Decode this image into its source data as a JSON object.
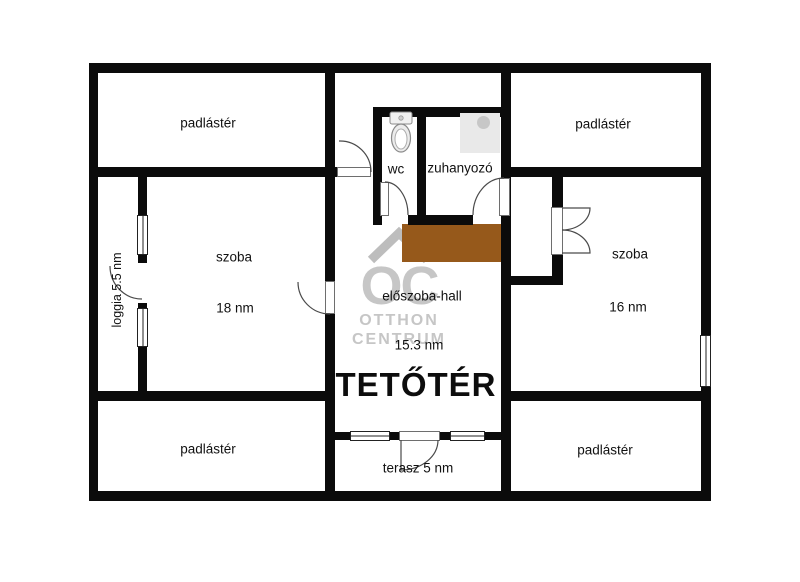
{
  "floor_title": "TETŐTÉR",
  "rooms": {
    "attic_top_left": {
      "label": "padlástér"
    },
    "attic_top_right": {
      "label": "padlástér"
    },
    "attic_bottom_left": {
      "label": "padlástér"
    },
    "attic_bottom_right": {
      "label": "padlástér"
    },
    "room_left": {
      "label": "szoba",
      "area": "18 nm"
    },
    "room_right": {
      "label": "szoba",
      "area": "16 nm"
    },
    "wc": {
      "label": "wc"
    },
    "shower": {
      "label": "zuhanyozó"
    },
    "hall": {
      "label": "előszoba-hall",
      "area": "15.3 nm"
    },
    "terrace": {
      "label": "terasz 5 nm"
    },
    "loggia": {
      "label": "loggia 5.5 nm"
    }
  },
  "watermark": {
    "logo": "OC",
    "line1": "OTTHON",
    "line2": "CENTRUM"
  },
  "colors": {
    "wall": "#0b0b0b",
    "stairs_brown": "#96591B",
    "watermark_gray": "#C6C6C6"
  }
}
